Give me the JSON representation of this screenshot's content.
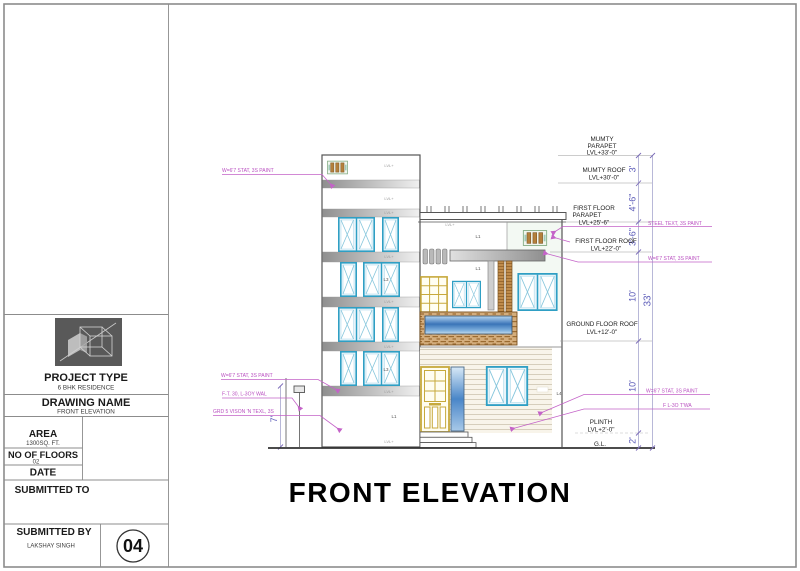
{
  "sheet": {
    "drawing_title": "FRONT ELEVATION",
    "sheet_number": "04"
  },
  "title_block": {
    "project_type_label": "PROJECT TYPE",
    "project_type_value": "6 BHK RESIDENCE",
    "drawing_name_label": "DRAWING NAME",
    "drawing_name_value": "FRONT ELEVATION",
    "area_label": "AREA",
    "area_value": "1300SQ. FT.",
    "floors_label": "NO OF  FLOORS",
    "floors_value": "02",
    "date_label": "DATE",
    "submitted_to_label": "SUBMITTED TO",
    "submitted_by_label": "SUBMITTED BY",
    "submitted_by_value": "LAKSHAY SINGH"
  },
  "levels": {
    "mumty_parapet": {
      "l1": "MUMTY",
      "l2": "PARAPET",
      "lvl": "LVL+33'-0\""
    },
    "mumty_roof": {
      "l1": "MUMTY ROOF",
      "lvl": "LVL+30'-0\""
    },
    "first_floor_parapet": {
      "l1": "FIRST FLOOR",
      "l2": "PARAPET",
      "lvl": "LVL+25'-6\""
    },
    "first_floor_roof": {
      "l1": "FIRST FLOOR ROOF",
      "lvl": "LVL+22'-0\""
    },
    "ground_floor_roof": {
      "l1": "GROUND FLOOR ROOF",
      "lvl": "LVL+12'-0\""
    },
    "plinth": {
      "l1": "PLINTH",
      "lvl": "LVL+2'-0\""
    },
    "ground_line": {
      "l1": "G.L."
    }
  },
  "dims": {
    "mumty_parapet_h": "3'",
    "mumty_roof_h": "4'-6\"",
    "parapet_h": "3'-6\"",
    "first_floor_h": "10'",
    "ground_floor_h": "10'",
    "plinth_h": "2'",
    "total_h": "33'",
    "boundary_wall_h": "7'"
  },
  "annotations": {
    "a1": "W=6'7 STAT, 3S PAINT",
    "a2": "W=6'7 STAT, 3S PAINT",
    "a3": "F-T. 30, L-3OY WAL",
    "a4": "GRD 5 VISON 'N TEXL, 3S",
    "r1": "STEEL TEXT, 3S PAINT",
    "r2": "W=6'7 STAT, 3S PAINT",
    "r3": "W=6'7 STAT, 3S PAINT",
    "r4": "F L-3O T'WA"
  },
  "tags": {
    "marker": "LVL+",
    "t_l1": "L1",
    "t_l3": "L3",
    "t_l4": "L4"
  },
  "colors": {
    "window_frame": "#2f9fc4",
    "annotation": "#b94fc0",
    "dimension": "#5a5ab8",
    "louver_brown": "#b4803c",
    "door_yellow": "#c7a93c",
    "water_blue": "#3a74b8"
  }
}
